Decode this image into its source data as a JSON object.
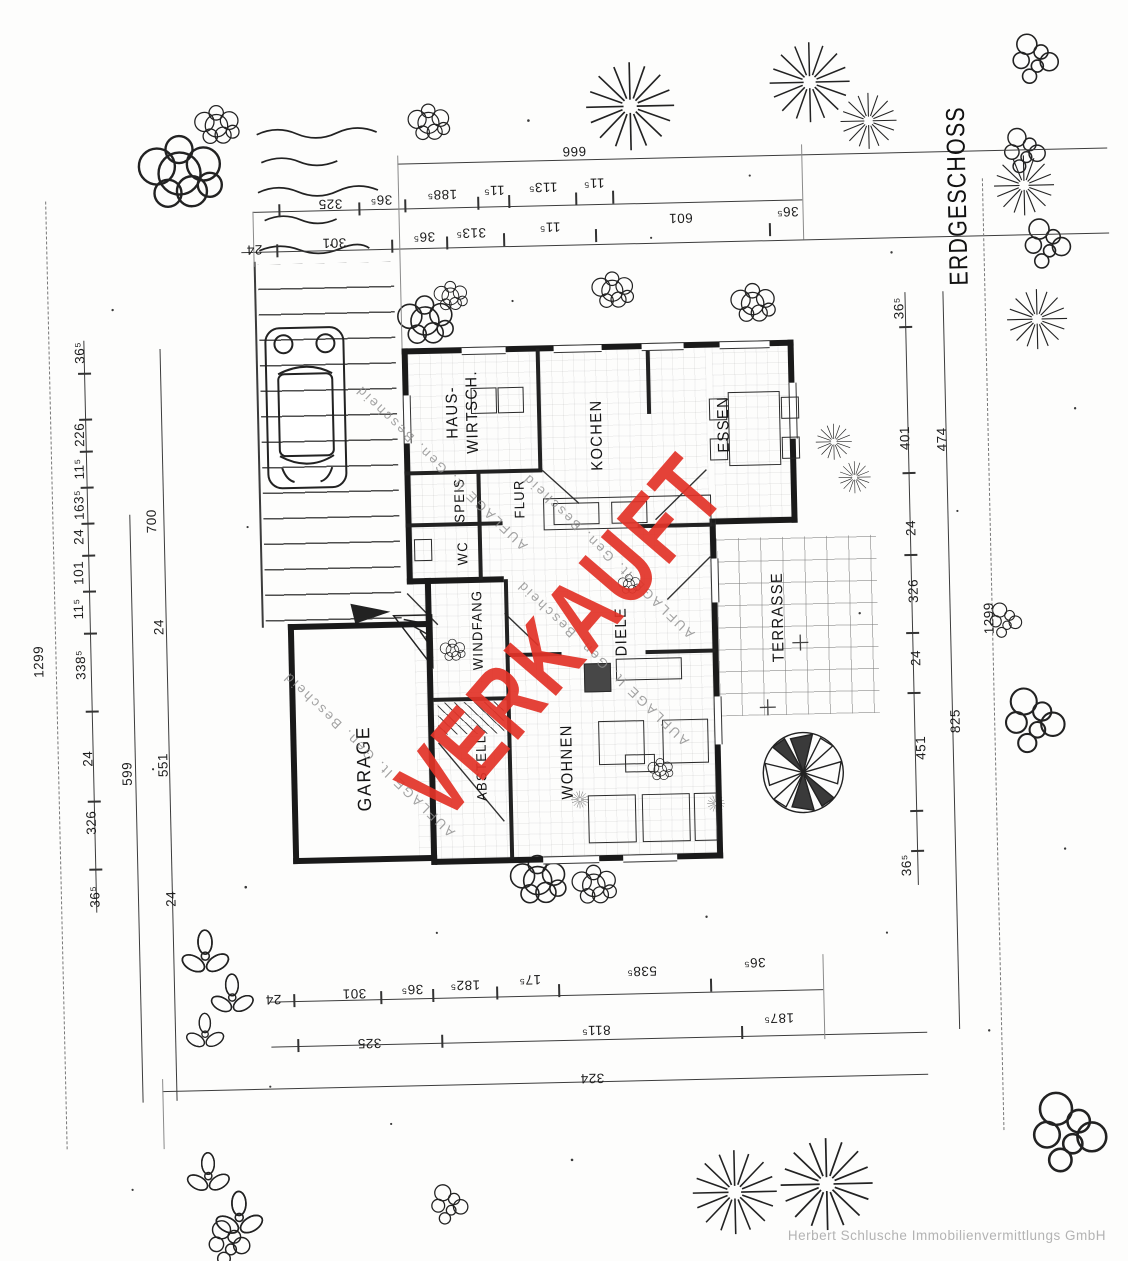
{
  "title": "ERDGESCHOSS",
  "stamp": {
    "text": "VERKAUFT",
    "color": "#e23328"
  },
  "watermark": {
    "text": "AUFLAGE lt. Gen. Bescheid"
  },
  "footer": {
    "company": "Herbert Schlusche Immobilienvermittlungs GmbH"
  },
  "rooms": {
    "hauswirtsch": "HAUS-\nWIRTSCH.",
    "speis": "SPEIS",
    "wc": "WC",
    "flur": "FLUR",
    "kochen": "KOCHEN",
    "essen": "ESSEN",
    "windfang": "WINDFANG",
    "abstell": "ABSTELL",
    "wohnen": "WOHNEN",
    "diele": "DIELE",
    "terrasse": "TERRASSE",
    "garage": "GARAGE"
  },
  "dims": {
    "top1": [
      "666"
    ],
    "top2": [
      "325",
      "36⁵",
      "188⁵",
      "11⁵",
      "113⁵",
      "11⁵"
    ],
    "top3": [
      "24",
      "301",
      "36⁵",
      "313⁵",
      "11⁵",
      "601",
      "36⁵"
    ],
    "bottom1": [
      "24",
      "301",
      "36⁵",
      "182⁵",
      "17⁵",
      "538⁵",
      "36⁵"
    ],
    "bottom2": [
      "325",
      "811⁵",
      "187⁵"
    ],
    "bottom3": [
      "324"
    ],
    "left_outer": [
      "1299"
    ],
    "left_chain": [
      "36⁵",
      "226",
      "11⁵",
      "163⁵",
      "24",
      "101",
      "11⁵",
      "338⁵",
      "24",
      "326",
      "36⁵"
    ],
    "left_mid": [
      "700",
      "24",
      "599",
      "551",
      "24"
    ],
    "right_chain": [
      "36⁵",
      "401",
      "24",
      "326",
      "24",
      "451",
      "36⁵"
    ],
    "right_mid": [
      "474",
      "825"
    ],
    "right_outer": [
      "1299"
    ]
  }
}
